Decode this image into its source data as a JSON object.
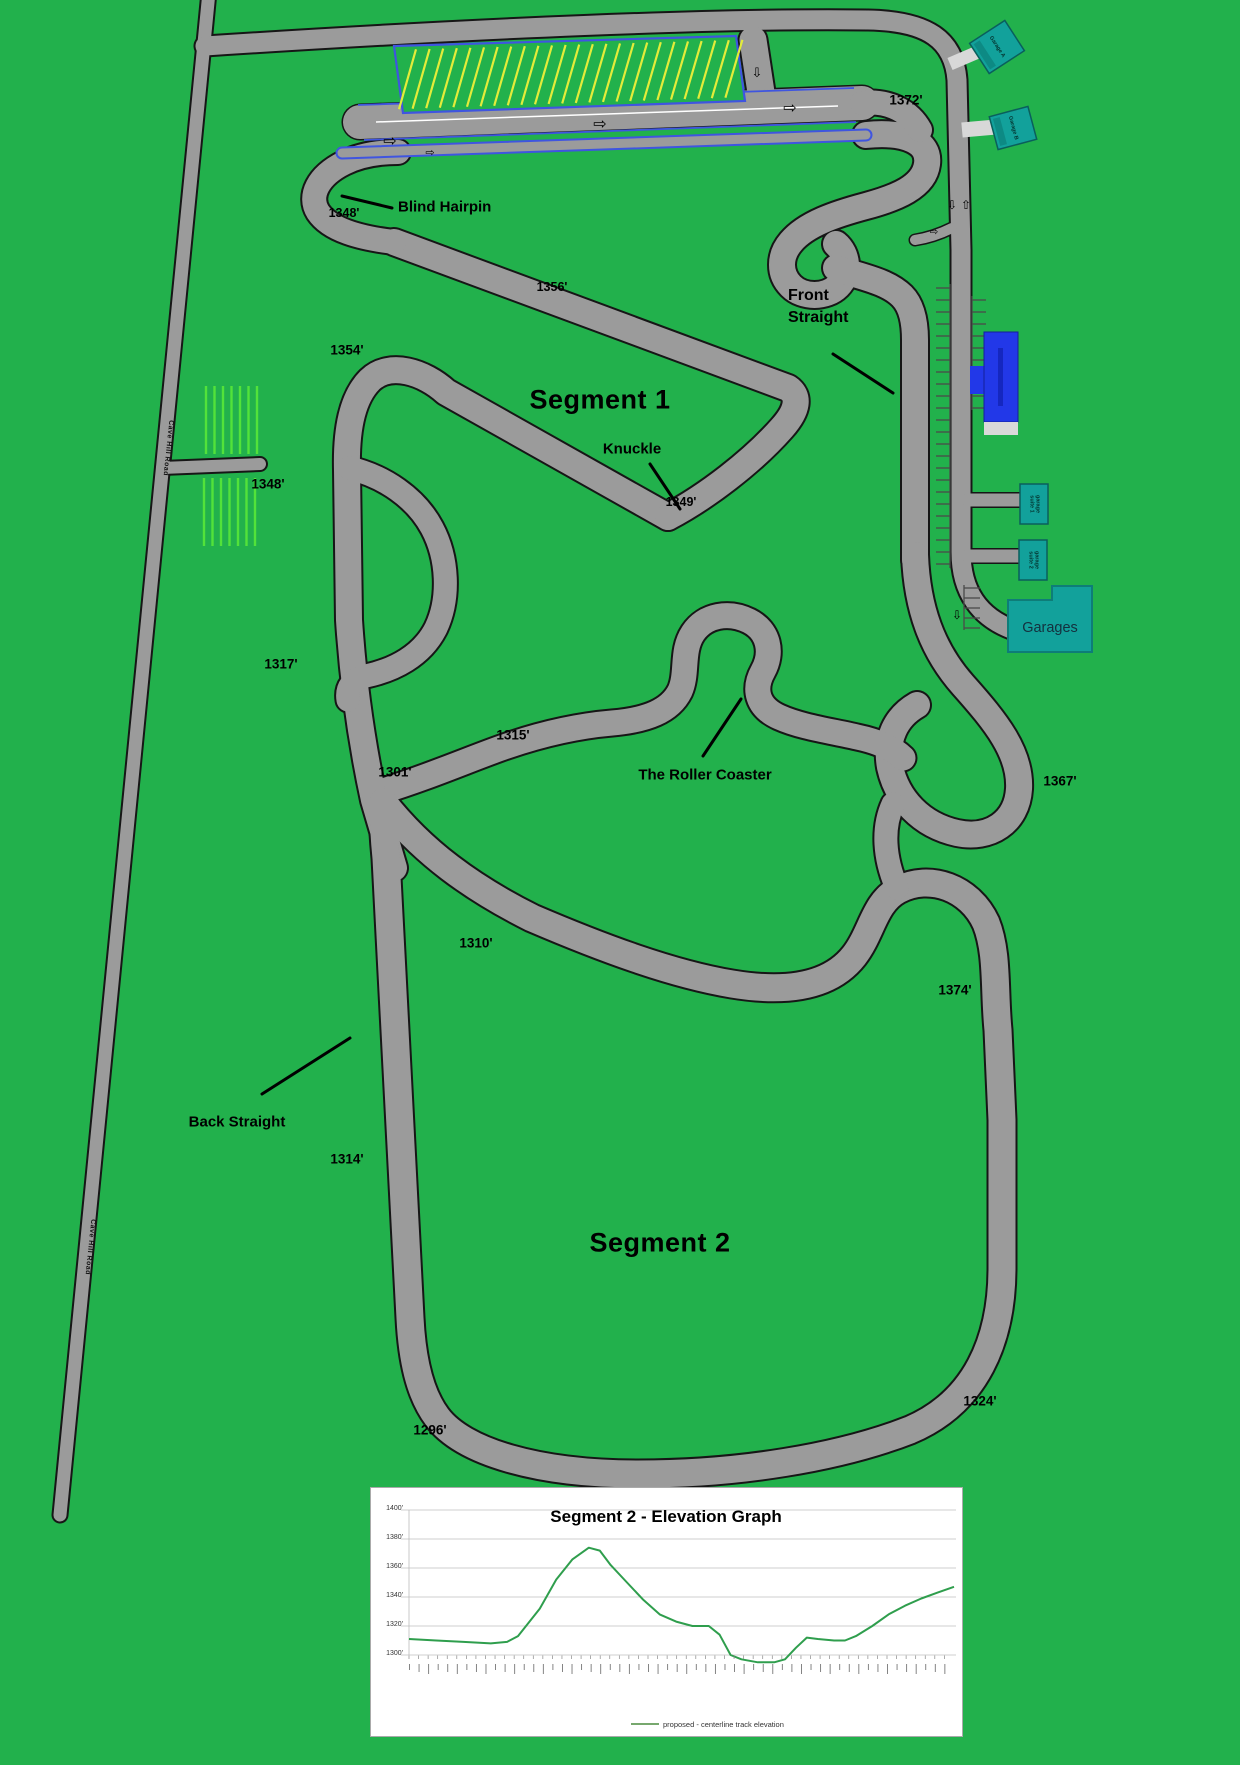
{
  "map": {
    "background_color": "#22b14c",
    "road_color": "#9b9b9b",
    "road_name": "Cave Hill Road",
    "segments": {
      "s1": "Segment 1",
      "s2": "Segment 2"
    },
    "corners": {
      "blind_hairpin": "Blind Hairpin",
      "knuckle": "Knuckle",
      "front_straight_l1": "Front",
      "front_straight_l2": "Straight",
      "roller_coaster": "The Roller Coaster",
      "back_straight": "Back Straight"
    },
    "elevations": {
      "e1372": "1372'",
      "e1348_hairpin": "1348'",
      "e1356": "1356'",
      "e1354": "1354'",
      "e1349": "1349'",
      "e1348_west": "1348'",
      "e1317": "1317'",
      "e1301": "1301'",
      "e1315": "1315'",
      "e1367": "1367'",
      "e1310": "1310'",
      "e1374": "1374'",
      "e1314": "1314'",
      "e1296": "1296'",
      "e1324": "1324'"
    },
    "buildings": {
      "garage_a": "Garage A",
      "garage_b": "Garage B",
      "suite1_l1": "garage",
      "suite1_l2": "suite 1",
      "suite2_l1": "garage",
      "suite2_l2": "suite 2",
      "garages": "Garages",
      "teal_color": "#12a19b",
      "blue_building_color": "#2238e8"
    },
    "icons": {
      "arrow_right": "⇨",
      "arrow_up": "⇧",
      "arrow_down": "⇩"
    }
  },
  "chart": {
    "title": "Segment 2 - Elevation Graph",
    "y_ticks": [
      "1400'",
      "1380'",
      "1360'",
      "1340'",
      "1320'",
      "1300'"
    ],
    "legend_label": "proposed - centerline track elevation",
    "line_color": "#2f9e4d"
  },
  "chart_data": {
    "type": "line",
    "title": "Segment 2 - Elevation Graph",
    "xlabel": "",
    "ylabel": "elevation (ft)",
    "ylim": [
      1290,
      1400
    ],
    "y_tick_labels": [
      "1400'",
      "1380'",
      "1360'",
      "1340'",
      "1320'",
      "1300'"
    ],
    "x_axis_note": "dense station-distance tick labels along x-axis, illegible at source resolution",
    "legend_position": "bottom-center",
    "grid": "horizontal",
    "series": [
      {
        "name": "proposed - centerline track elevation",
        "points": [
          [
            0.0,
            1311
          ],
          [
            0.05,
            1310
          ],
          [
            0.1,
            1309
          ],
          [
            0.15,
            1308
          ],
          [
            0.18,
            1309
          ],
          [
            0.2,
            1313
          ],
          [
            0.24,
            1332
          ],
          [
            0.27,
            1352
          ],
          [
            0.3,
            1366
          ],
          [
            0.33,
            1374
          ],
          [
            0.35,
            1372
          ],
          [
            0.37,
            1362
          ],
          [
            0.4,
            1350
          ],
          [
            0.43,
            1338
          ],
          [
            0.46,
            1328
          ],
          [
            0.49,
            1323
          ],
          [
            0.52,
            1320
          ],
          [
            0.55,
            1320
          ],
          [
            0.57,
            1314
          ],
          [
            0.59,
            1300
          ],
          [
            0.61,
            1297
          ],
          [
            0.64,
            1295
          ],
          [
            0.67,
            1295
          ],
          [
            0.69,
            1297
          ],
          [
            0.71,
            1305
          ],
          [
            0.73,
            1312
          ],
          [
            0.75,
            1311
          ],
          [
            0.78,
            1310
          ],
          [
            0.8,
            1310
          ],
          [
            0.82,
            1313
          ],
          [
            0.85,
            1320
          ],
          [
            0.88,
            1328
          ],
          [
            0.91,
            1334
          ],
          [
            0.94,
            1339
          ],
          [
            0.97,
            1343
          ],
          [
            1.0,
            1347
          ]
        ]
      }
    ]
  }
}
